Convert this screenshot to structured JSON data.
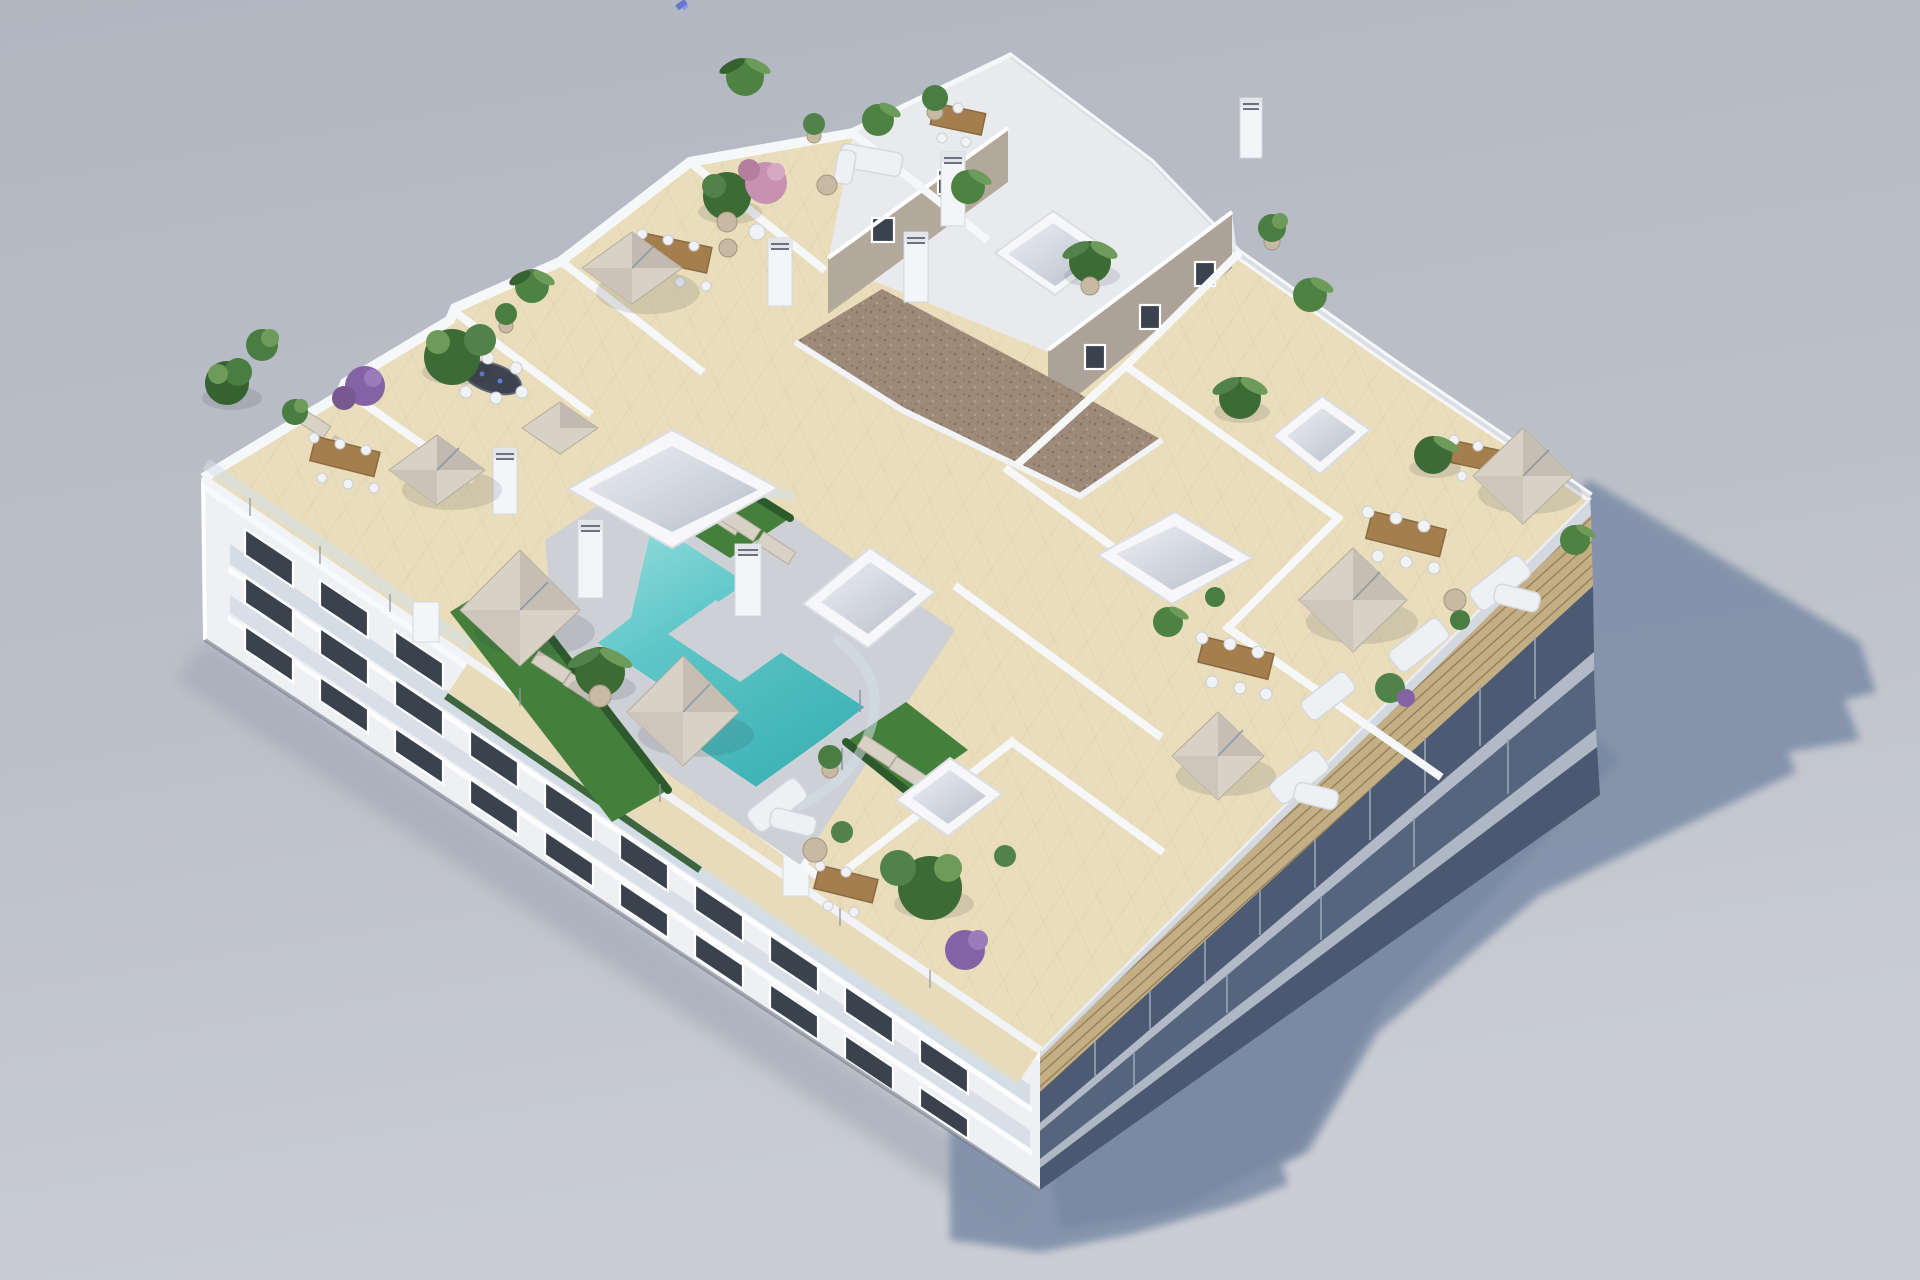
{
  "scene": {
    "description": "Aerial 3D architectural rendering of a white apartment block rooftop: communal terrace with Z-shaped turquoise pool, artificial grass, glass balustrades, private roof terraces with beige cantilever parasols, wooden dining sets, white lounge sofas and potted plants; gravel-roofed stair core; sunlit southwest facade with balconies; shaded blue southeast facade with slatted pergola; long blue shadow cast on plain grey ground",
    "view": "isometric-style aerial view from above",
    "ground": {
      "top_color": "#b2b6c1",
      "bottom_color": "#cacdd4"
    },
    "colors": {
      "bg_top": "#b2b6c1",
      "bg_bottom": "#cacdd4",
      "ground_shadow": "#8090a9",
      "penumbra": "#99a1b0",
      "wall_white": "#f3f4f7",
      "wall_shade": "#d9dce3",
      "parapet": "#f6f7f9",
      "roof_tile": "#e9ddbb",
      "tile_line": "#d7c69e",
      "deck": "#cdd0d4",
      "pool": "#5ec6c8",
      "pool_deep": "#3fb3b6",
      "pool_light": "#9adfdd",
      "grass": "#44803c",
      "hedge": "#2d5a2c",
      "plant": "#4a7d41",
      "plant_dark": "#35622e",
      "plant_light": "#6d9b59",
      "pink_tree": "#c791b1",
      "purple_bush": "#8363a6",
      "gravel": "#9d8a78",
      "gravel_dark": "#83705e",
      "greige_wall": "#b2a89c",
      "slat": "#c4ae83",
      "slat_line": "#8d7a55",
      "se_dark": "#54637c",
      "se_mid": "#8f9cb0",
      "se_light": "#b3bbc8",
      "window": "#3a424e",
      "window_frame": "#ffffff",
      "balcony_glass": "#b9c8d6",
      "glass_fence": "#d4e0ea",
      "umbrella": "#d8d1c5",
      "umbrella_shade": "#c2bab0",
      "wood": "#a57e4e",
      "wood_dark": "#8a6a40",
      "sofa": "#eef0f3",
      "chimney_vent": "#6a7280",
      "artifact_blue": "#5b6bd5"
    },
    "objects": {
      "pool": {
        "shape": "Z-shaped",
        "color": "#5ec6c8",
        "surround": "grey deck with glass balustrade and grass"
      },
      "parasols": 8,
      "sun_loungers": 10,
      "dining_tables": 8,
      "lounge_sofas": 6,
      "skylight_boxes": 6,
      "chimneys": 7,
      "plants": 28,
      "gravel_roof": true,
      "slatted_pergola_edge": true,
      "glass_balustrades": true,
      "facade_window_rows": 3
    },
    "artifact": {
      "note": "tiny blue speck top centre of sky",
      "color": "#5b6bd5"
    }
  }
}
